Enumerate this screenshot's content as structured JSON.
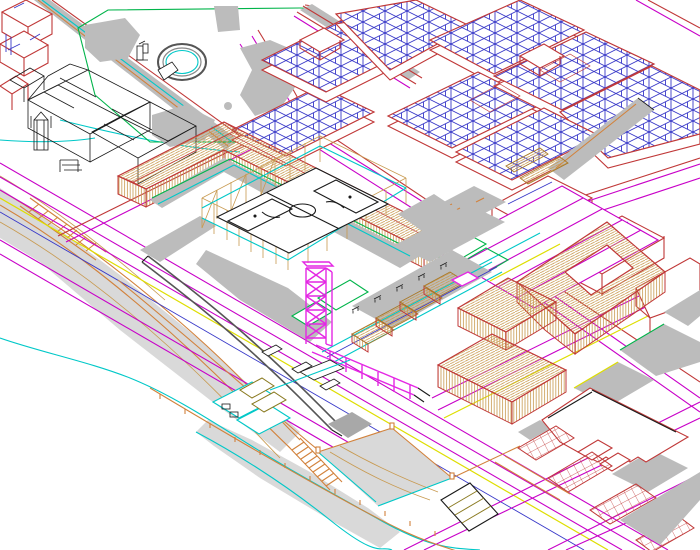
{
  "canvas": {
    "width": 700,
    "height": 550,
    "kind": "axonometric-cad-city-plan"
  },
  "colors": {
    "magenta": "#c800c8",
    "bright_magenta": "#e428e4",
    "red": "#c03838",
    "dark_red": "#9a2828",
    "blue": "#3838c8",
    "tan": "#c89a50",
    "tan_dark": "#a87828",
    "orange": "#d2823c",
    "green": "#00b44a",
    "cyan": "#00c8c8",
    "yellow": "#dede00",
    "black": "#1a1a1a",
    "dark_gray": "#555555",
    "gray_fill": "#bcbcbc",
    "light_gray": "#d9d9d9",
    "olive": "#8a7a20"
  },
  "landmarks": [
    "public-park-with-circular-plaza",
    "historic-church-wireframe",
    "dense-city-blocks-with-parcel-lines",
    "l-shaped-hatched-building",
    "soccer-field-with-fence",
    "magenta-lattice-tower",
    "elevated-walkway",
    "market-stalls-row",
    "courtyard-donut-building",
    "parcel-strip-field",
    "seafront-cliff-with-stairs",
    "beach-terraces",
    "sports-court",
    "parking-rows",
    "large-waterfront-building"
  ],
  "counts": {
    "city_blocks": 8,
    "market_stalls": 4,
    "parking_rows": 4,
    "fence_posts": 21
  }
}
